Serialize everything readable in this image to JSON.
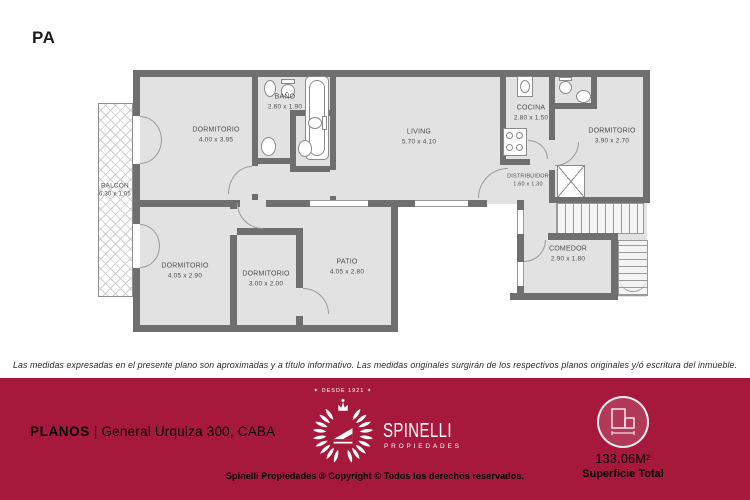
{
  "plan": {
    "level_label": "PA",
    "rooms": [
      {
        "name": "DORMITORIO",
        "dims": "4.00 x 3.95"
      },
      {
        "name": "BAÑO",
        "dims": "2.60 x 1.90"
      },
      {
        "name": "LIVING",
        "dims": "5.70 x 4.10"
      },
      {
        "name": "COCINA",
        "dims": "2.80 x 1.50"
      },
      {
        "name": "DORMITORIO",
        "dims": "3.90 x 2.70"
      },
      {
        "name": "BALCÓN",
        "dims": "6.30 x 1.05"
      },
      {
        "name": "DISTRIBUIDOR",
        "dims": "1.60 x 1.30"
      },
      {
        "name": "DORMITORIO",
        "dims": "4.05 x 2.90"
      },
      {
        "name": "DORMITORIO",
        "dims": "3.00 x 2.00"
      },
      {
        "name": "PATIO",
        "dims": "4.05 x 2.80"
      },
      {
        "name": "COMEDOR",
        "dims": "2.90 x 1.80"
      }
    ]
  },
  "disclaimer": "Las medidas expresadas en el presente plano son aproximadas y a título informativo. Las medidas originales surgirán de los respectivos planos originales y/ó escritura del inmueble.",
  "footer": {
    "doc_type": "PLANOS",
    "separator": "|",
    "address": "General Urquiza 300, CABA",
    "brand": {
      "since_label": "✦ DESDE 1921 ✦",
      "name": "SPINELLI",
      "subtitle": "PROPIEDADES"
    },
    "copyright": "Spinelli Propiedades ® Copyright © Todos los derechos reservados.",
    "surface": {
      "value": "133.06M²",
      "label": "Superficie Total"
    }
  },
  "colors": {
    "footer_bg": "#a6193c",
    "wall": "#6f6f6f",
    "room_fill": "#e2e2e2",
    "label_ink": "#4d4d4d"
  }
}
